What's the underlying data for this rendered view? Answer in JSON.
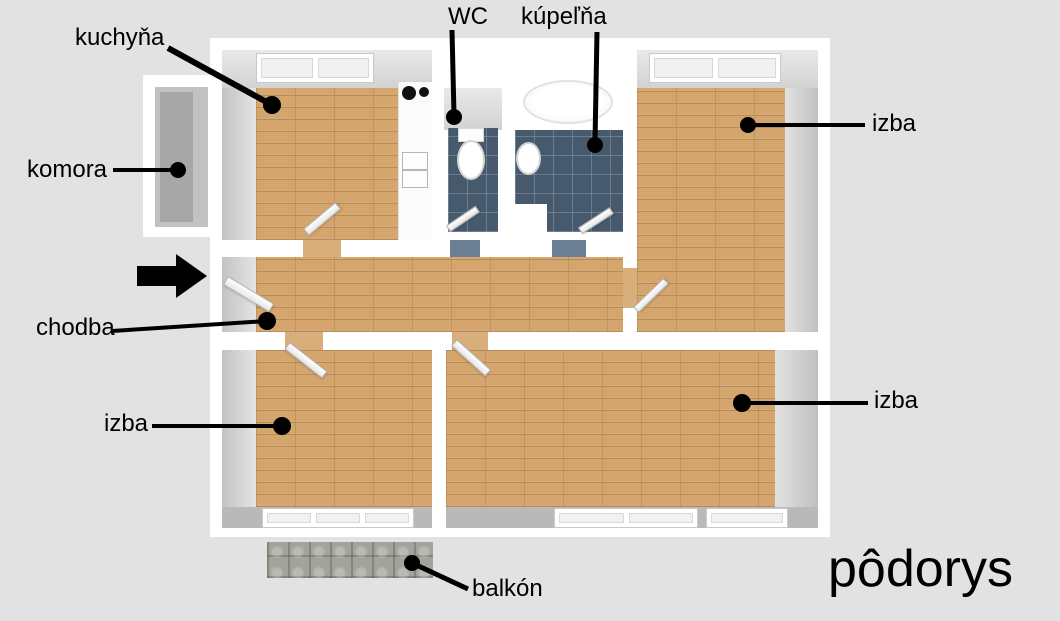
{
  "title": "pôdorys",
  "rooms": {
    "kitchen": {
      "label": "kuchyňa"
    },
    "pantry": {
      "label": "komora"
    },
    "wc": {
      "label": "WC"
    },
    "bathroom": {
      "label": "kúpeľňa"
    },
    "hallway": {
      "label": "chodba"
    },
    "room_top_right": {
      "label": "izba"
    },
    "room_bottom_left": {
      "label": "izba"
    },
    "room_bottom_right": {
      "label": "izba"
    },
    "balcony": {
      "label": "balkón"
    }
  },
  "icons": {
    "entrance_arrow": "right-arrow"
  },
  "colors": {
    "background": "#e2e2e2",
    "wall": "#ffffff",
    "wall_shadow": "#c3c3c3",
    "wood_floor": "#d4a56c",
    "tile_floor": "#46596d",
    "balcony_floor": "#a3a39c",
    "label_text": "#000000"
  }
}
